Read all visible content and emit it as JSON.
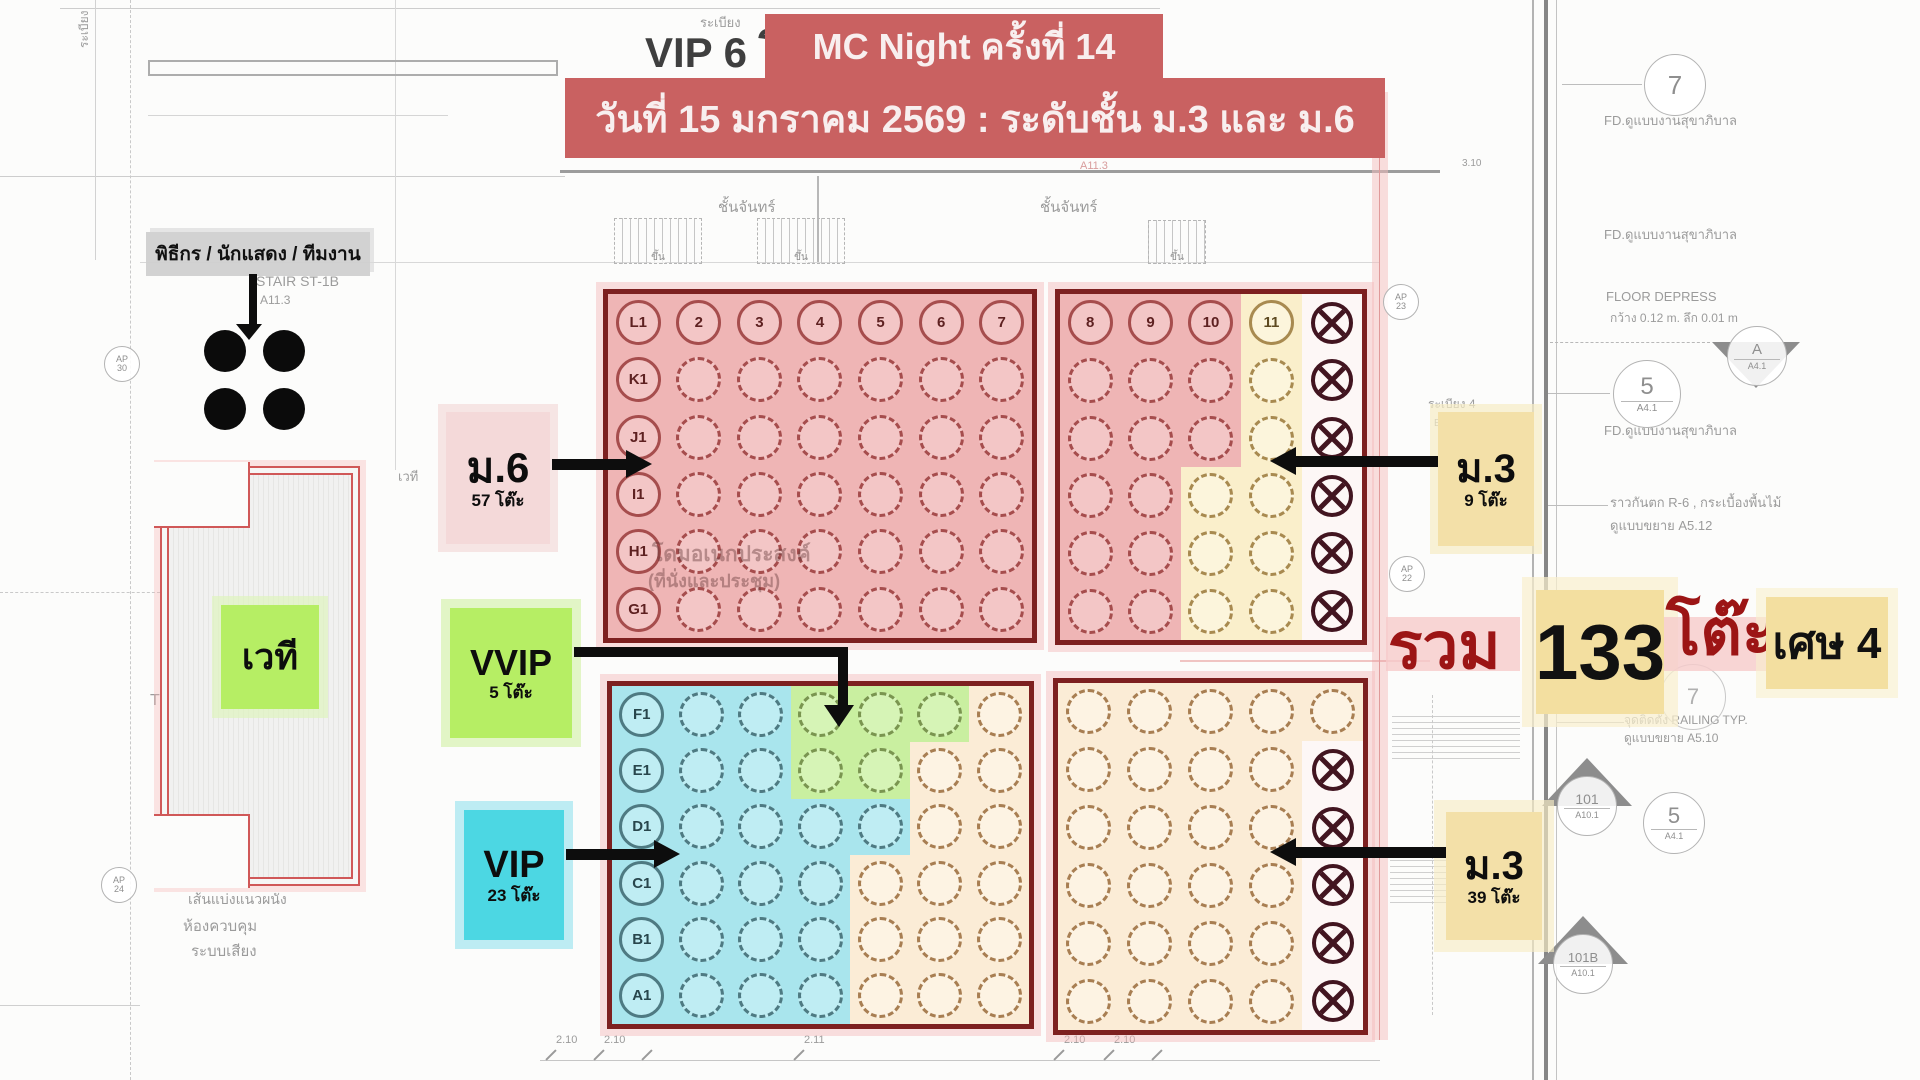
{
  "banner": {
    "line1": "MC Night ครั้งที่ 14",
    "line2": "วันที่ 15 มกราคม 2569 : ระดับชั้น ม.3 และ ม.6"
  },
  "labels": {
    "mc_team": "พิธีกร / นักแสดง / ทีมงาน",
    "stage": "เวที",
    "m6": {
      "title": "ม.6",
      "count": "57 โต๊ะ"
    },
    "m3_top": {
      "title": "ม.3",
      "count": "9 โต๊ะ"
    },
    "vvip": {
      "title": "VVIP",
      "count": "5 โต๊ะ"
    },
    "vip": {
      "title": "VIP",
      "count": "23 โต๊ะ"
    },
    "m3_bottom": {
      "title": "ม.3",
      "count": "39 โต๊ะ"
    }
  },
  "total": {
    "prefix": "รวม",
    "number": "133",
    "unit": "โต๊ะ",
    "remainder": "เศษ 4"
  },
  "colors": {
    "banner": "#c96161",
    "block_border": "#7d2020",
    "zone_red": "#efb5b5",
    "zone_yellow": "#faefcb",
    "zone_blue": "#a9e5ed",
    "zone_green": "#c9efa0",
    "zone_orange": "#fbecd6",
    "tag_pink": "#f4d9d9",
    "tag_yellow": "#f3e0a8",
    "tag_green": "#b6ee64",
    "tag_cyan": "#4cd7e3",
    "total_red": "#9c1515"
  },
  "blocks": {
    "top_left": {
      "cols": 7,
      "rows": [
        [
          "L1.r",
          "2.r",
          "3.r",
          "4.r",
          "5.r",
          "6.r",
          "7.r"
        ],
        [
          "K1.r",
          ".r",
          ".r",
          ".r",
          ".r",
          ".r",
          ".r"
        ],
        [
          "J1.r",
          ".r",
          ".r",
          ".r",
          ".r",
          ".r",
          ".r"
        ],
        [
          "I1.r",
          ".r",
          ".r",
          ".r",
          ".r",
          ".r",
          ".r"
        ],
        [
          "H1.r",
          ".r",
          ".r",
          ".r",
          ".r",
          ".r",
          ".r"
        ],
        [
          "G1.r",
          ".r",
          ".r",
          ".r",
          ".r",
          ".r",
          ".r"
        ]
      ]
    },
    "top_right": {
      "cols": 5,
      "rows": [
        [
          "8.r",
          "9.r",
          "10.r",
          "11.y",
          "X.w"
        ],
        [
          ".r",
          ".r",
          ".r",
          ".y",
          "X.w"
        ],
        [
          ".r",
          ".r",
          ".r",
          ".y",
          "X.w"
        ],
        [
          ".r",
          ".r",
          ".y",
          ".y",
          "X.w"
        ],
        [
          ".r",
          ".r",
          ".y",
          ".y",
          "X.w"
        ],
        [
          ".r",
          ".r",
          ".y",
          ".y",
          "X.w"
        ]
      ]
    },
    "bottom_left": {
      "cols": 7,
      "rows": [
        [
          "F1.b",
          ".b",
          ".b",
          ".g",
          ".g",
          ".g",
          ".o"
        ],
        [
          "E1.b",
          ".b",
          ".b",
          ".g",
          ".g",
          ".o",
          ".o"
        ],
        [
          "D1.b",
          ".b",
          ".b",
          ".b",
          ".b",
          ".o",
          ".o"
        ],
        [
          "C1.b",
          ".b",
          ".b",
          ".b",
          ".o",
          ".o",
          ".o"
        ],
        [
          "B1.b",
          ".b",
          ".b",
          ".b",
          ".o",
          ".o",
          ".o"
        ],
        [
          "A1.b",
          ".b",
          ".b",
          ".b",
          ".o",
          ".o",
          ".o"
        ]
      ]
    },
    "bottom_right": {
      "cols": 5,
      "rows": [
        [
          ".o",
          ".o",
          ".o",
          ".o",
          ".o"
        ],
        [
          ".o",
          ".o",
          ".o",
          ".o",
          "X.w"
        ],
        [
          ".o",
          ".o",
          ".o",
          ".o",
          "X.w"
        ],
        [
          ".o",
          ".o",
          ".o",
          ".o",
          "X.w"
        ],
        [
          ".o",
          ".o",
          ".o",
          ".o",
          "X.w"
        ],
        [
          ".o",
          ".o",
          ".o",
          ".o",
          "X.w"
        ]
      ]
    }
  },
  "plan_text": {
    "balcony_tl": "ระเบียง",
    "balcony_top": "ระเบียง",
    "vip6": "VIP 6 โ",
    "stair_st1b": "STAIR ST-1B",
    "a113": "A11.3",
    "chan": "ชั้นจันทร์",
    "up": "ขึ้น",
    "dome1": "โดมอเนกประสงค์",
    "dome2": "(ที่นั่งและประชุม)",
    "fd_note": "FD.ดูแบบงานสุขาภิบาล",
    "floor_depress": "FLOOR DEPRESS",
    "floor_depress_dim": "กว้าง 0.12 m. ลึก 0.01 m",
    "railing_top1": "ราวกันตก R-6 , กระเบื้องพื้นไม้",
    "railing_top2": "ดูแบบขยาย A5.12",
    "railing_bottom1": "จุดติดตั้ง RAILING TYP.",
    "railing_bottom2": "ดูแบบขยาย A5.10",
    "balcony4": "ระเบียง 4",
    "el": "EL.",
    "el530": "EL.+5.30",
    "toilet": "TOILET",
    "wall_line": "เส้นแบ่งแนวผนัง",
    "control1": "ห้องควบคุม",
    "control2": "ระบบเสียง",
    "stage_small": "เวที",
    "t2": "T-2",
    "d310": "3.10",
    "dims": [
      "2.10",
      "2.10",
      "2.11",
      "2.10",
      "2.10"
    ]
  },
  "markers": {
    "c7": "7",
    "c7b": "7",
    "c5": {
      "top": "5",
      "bottom": "A4.1"
    },
    "cA": {
      "top": "A",
      "bottom": "A4.1"
    },
    "c101": {
      "top": "101",
      "bottom": "A10.1"
    },
    "c5b": {
      "top": "5",
      "bottom": "A4.1"
    },
    "c101b": {
      "top": "101B",
      "bottom": "A10.1"
    },
    "ap30": {
      "top": "AP",
      "bottom": "30"
    },
    "ap24": {
      "top": "AP",
      "bottom": "24"
    },
    "ap23": {
      "top": "AP",
      "bottom": "23"
    },
    "ap22": {
      "top": "AP",
      "bottom": "22"
    }
  }
}
